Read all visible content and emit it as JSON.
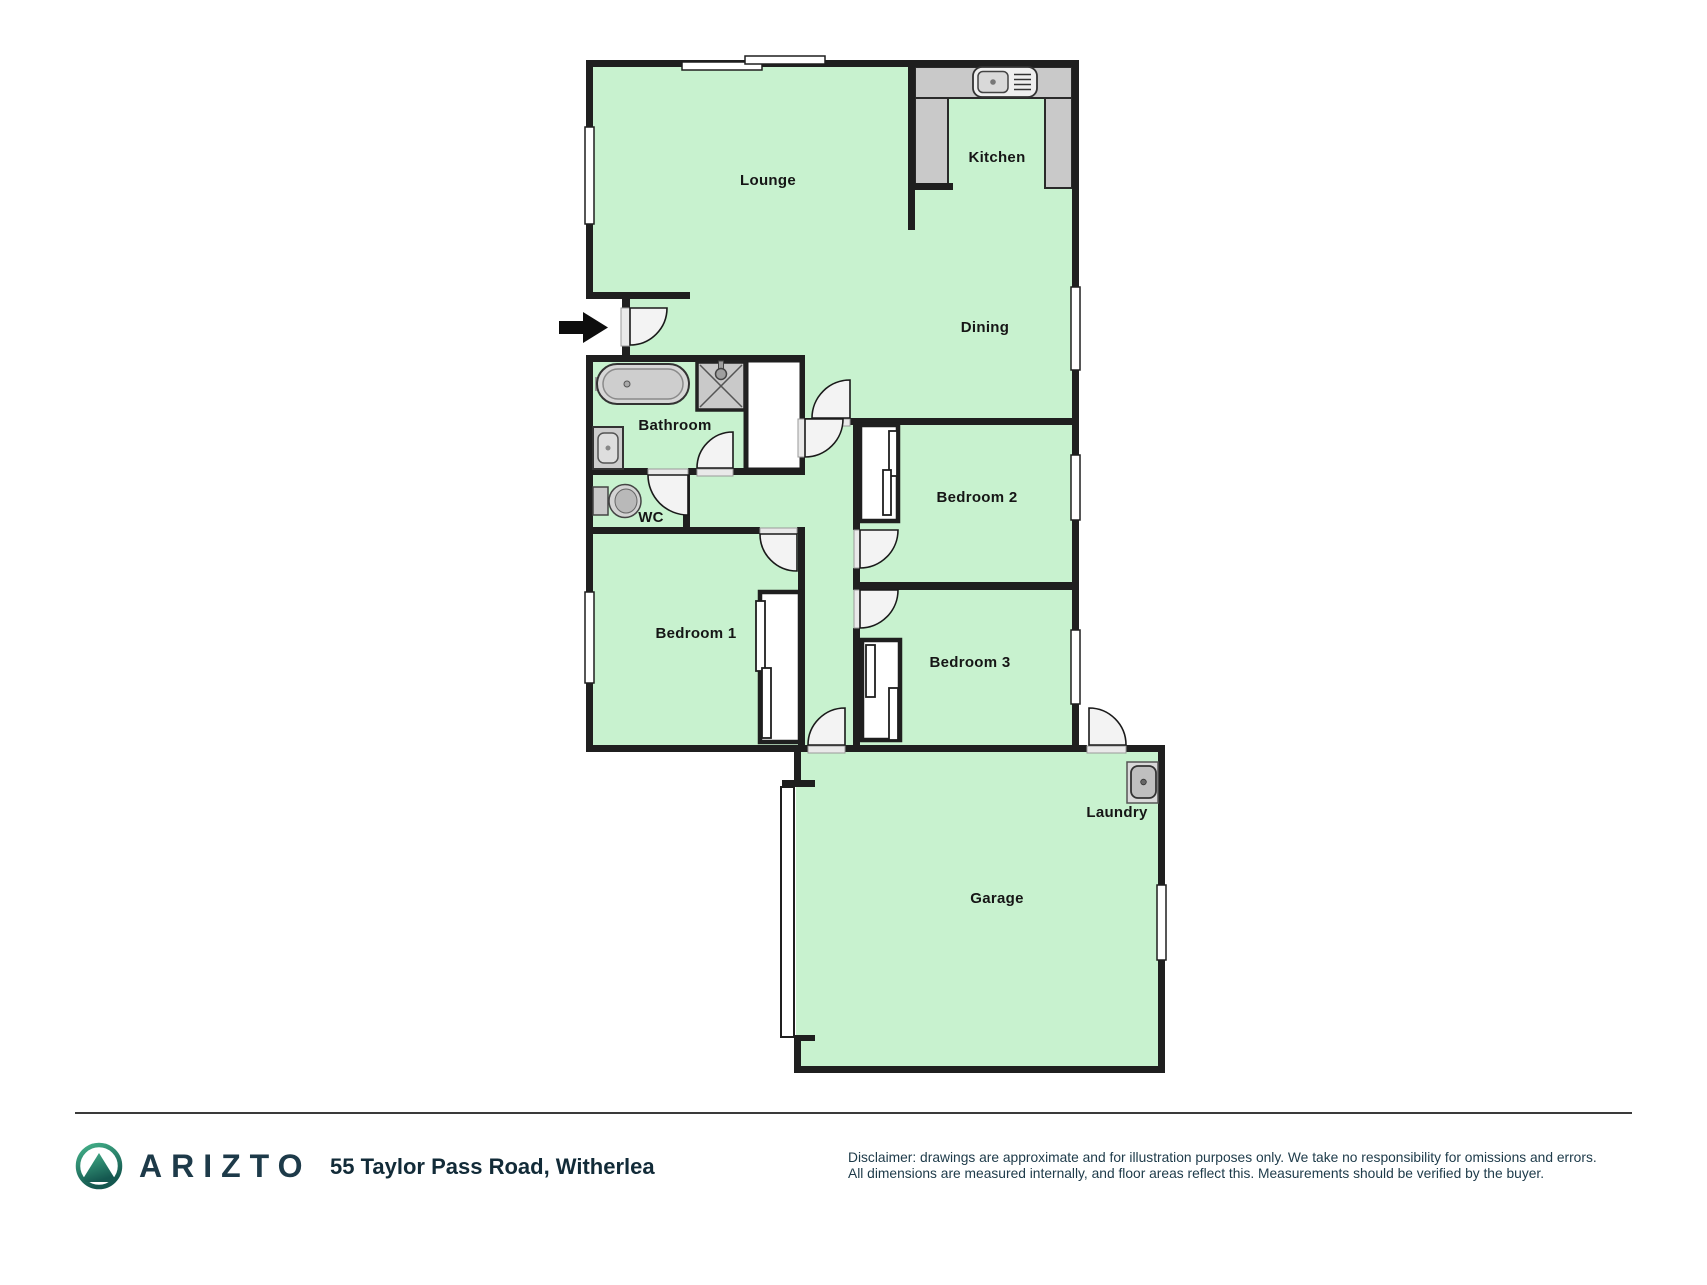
{
  "plan": {
    "rooms": [
      {
        "name": "Lounge"
      },
      {
        "name": "Kitchen"
      },
      {
        "name": "Dining"
      },
      {
        "name": "Bathroom"
      },
      {
        "name": "WC"
      },
      {
        "name": "Bedroom 1"
      },
      {
        "name": "Bedroom 2"
      },
      {
        "name": "Bedroom 3"
      },
      {
        "name": "Laundry"
      },
      {
        "name": "Garage"
      }
    ],
    "icons": [
      "entry-arrow-icon",
      "kitchen-sink-icon",
      "bathtub-icon",
      "shower-icon",
      "vanity-sink-icon",
      "toilet-icon",
      "laundry-tub-icon",
      "window",
      "door-swing"
    ],
    "colors": {
      "floor": "#c8f2cf",
      "wall": "#1f1f1f",
      "counter": "#c9c9c9",
      "door_arc": "#f3f3f3",
      "fixture": "#d6d6d6"
    }
  },
  "footer": {
    "brand": "ARIZTO",
    "address": "55 Taylor Pass Road, Witherlea",
    "disclaimer_line1": "Disclaimer: drawings are approximate and for illustration purposes only. We take no responsibility for omissions and errors.",
    "disclaimer_line2": "All dimensions are measured internally, and floor areas reflect this. Measurements should be verified by the buyer.",
    "logo_green_light": "#43b189",
    "logo_green_dark": "#14574f"
  }
}
